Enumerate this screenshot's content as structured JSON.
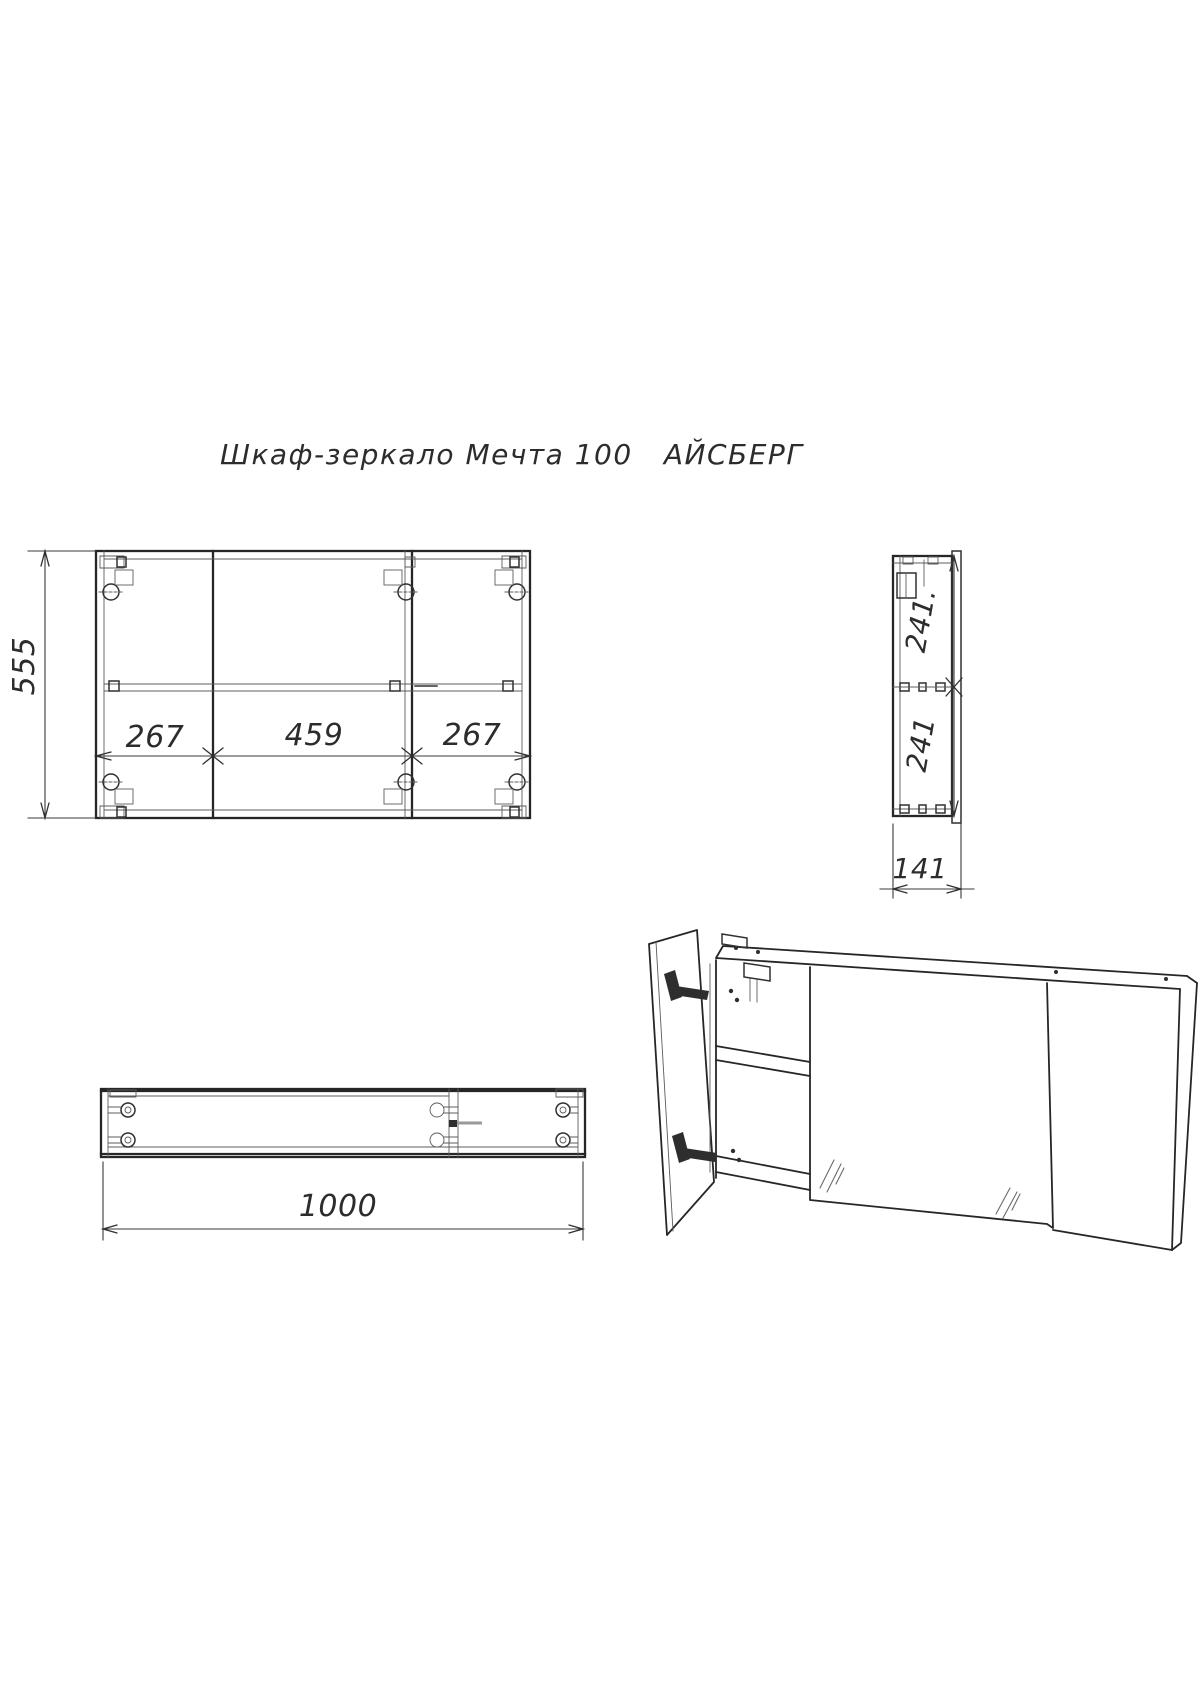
{
  "page": {
    "background": "#ffffff",
    "line_color": "#262626",
    "dim_color": "#2c2c2c"
  },
  "title": "Шкаф-зеркало Мечта 100   АЙСБЕРГ",
  "front_view": {
    "height_dim": "555",
    "width_dims": [
      "267",
      "459",
      "267"
    ]
  },
  "side_view": {
    "upper_dim": "241.",
    "lower_dim": "241",
    "depth_dim": "141"
  },
  "plan_view": {
    "width_dim": "1000"
  }
}
